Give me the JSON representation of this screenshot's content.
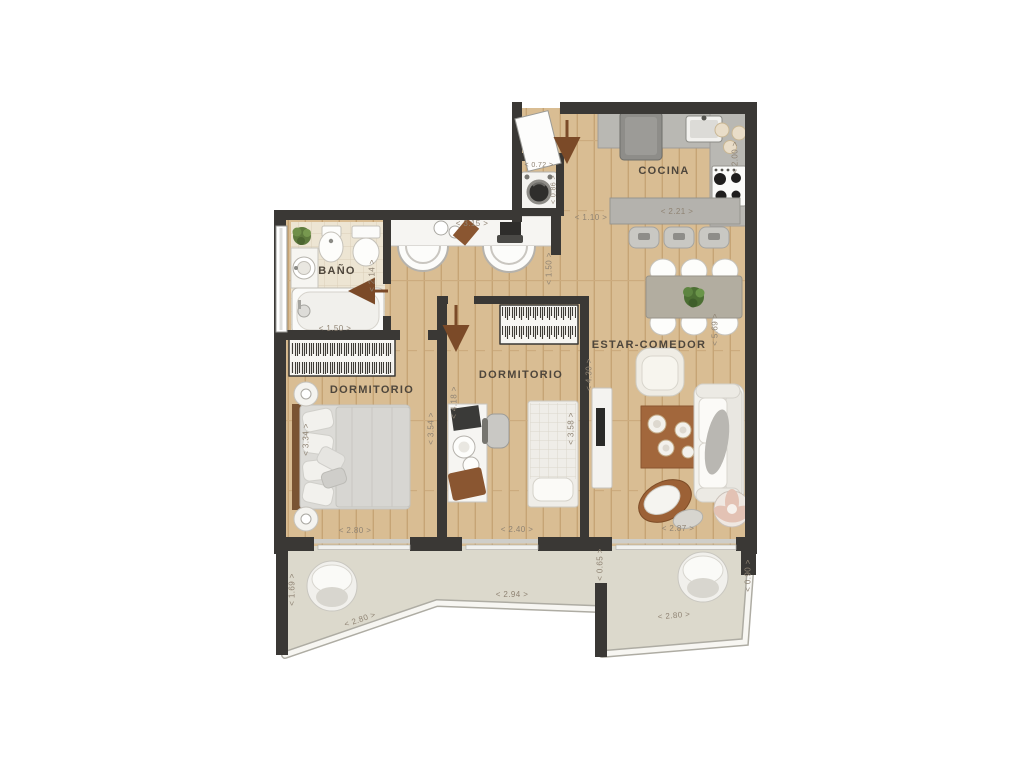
{
  "rooms": {
    "bathroom": "BAÑO",
    "bedroom1": "DORMITORIO",
    "bedroom2": "DORMITORIO",
    "kitchen": "COCINA",
    "living_dining": "ESTAR-COMEDOR",
    "terrace": "TERRAZA"
  },
  "dimensions": {
    "entry_closet_width": "< 0.72 >",
    "entry_closet_depth": "< 0.86 >",
    "entry_hall_width": "< 1.10 >",
    "kitchen_island_length": "< 2.21 >",
    "kitchen_depth": "< 2.00 >",
    "vanity_counter_length": "< 3.15 >",
    "hall_depth": "< 1.50 >",
    "bathroom_width": "< 1.50 >",
    "bathroom_depth": "< 2.14 >",
    "bedroom1_width": "< 2.80 >",
    "bedroom1_depth_left": "< 3.34 >",
    "bedroom1_depth_right": "< 3.54 >",
    "bedroom2_width": "< 2.40 >",
    "bedroom2_depth_left": "< 4.18 >",
    "bedroom2_bed_length": "< 3.58 >",
    "bedroom2_depth_right": "< 4.30 >",
    "living_depth": "< 5.69 >",
    "living_width": "< 2.87 >",
    "terrace_left_depth": "< 1.69 >",
    "terrace_left_edge": "< 2.80 >",
    "terrace_mid_width": "< 2.94 >",
    "terrace_mid_depth": "< 0.65 >",
    "terrace_right_depth": "< 0.90 >",
    "terrace_right_edge": "< 2.80 >"
  },
  "furniture_icons": [
    "double-bed-icon",
    "single-bed-icon",
    "wardrobe-icon",
    "desk-icon",
    "desk-chair-icon",
    "washing-machine-icon",
    "bathtub-icon",
    "toilet-icon",
    "bidet-icon",
    "washbasin-icon",
    "vanity-counter-icon",
    "kitchen-island-icon",
    "bar-stool-icon",
    "fridge-icon",
    "kitchen-sink-icon",
    "cooktop-icon",
    "dining-table-icon",
    "dining-chair-icon",
    "sofa-icon",
    "armchair-icon",
    "coffee-table-icon",
    "side-table-icon",
    "tv-unit-icon",
    "rug-icon",
    "egg-chair-icon",
    "plant-icon",
    "entry-arrow-icon",
    "door-arrow-icon"
  ],
  "colors": {
    "wall": "#3a3835",
    "wood_floor": "#d9bd93",
    "bathroom_tile": "#ede5d3",
    "terrace_floor": "#dcd9cc",
    "counter": "#b9b8b3",
    "accent_wood": "#8a5631",
    "room_label_text": "#4e463c",
    "dimension_text": "#8f8373"
  }
}
